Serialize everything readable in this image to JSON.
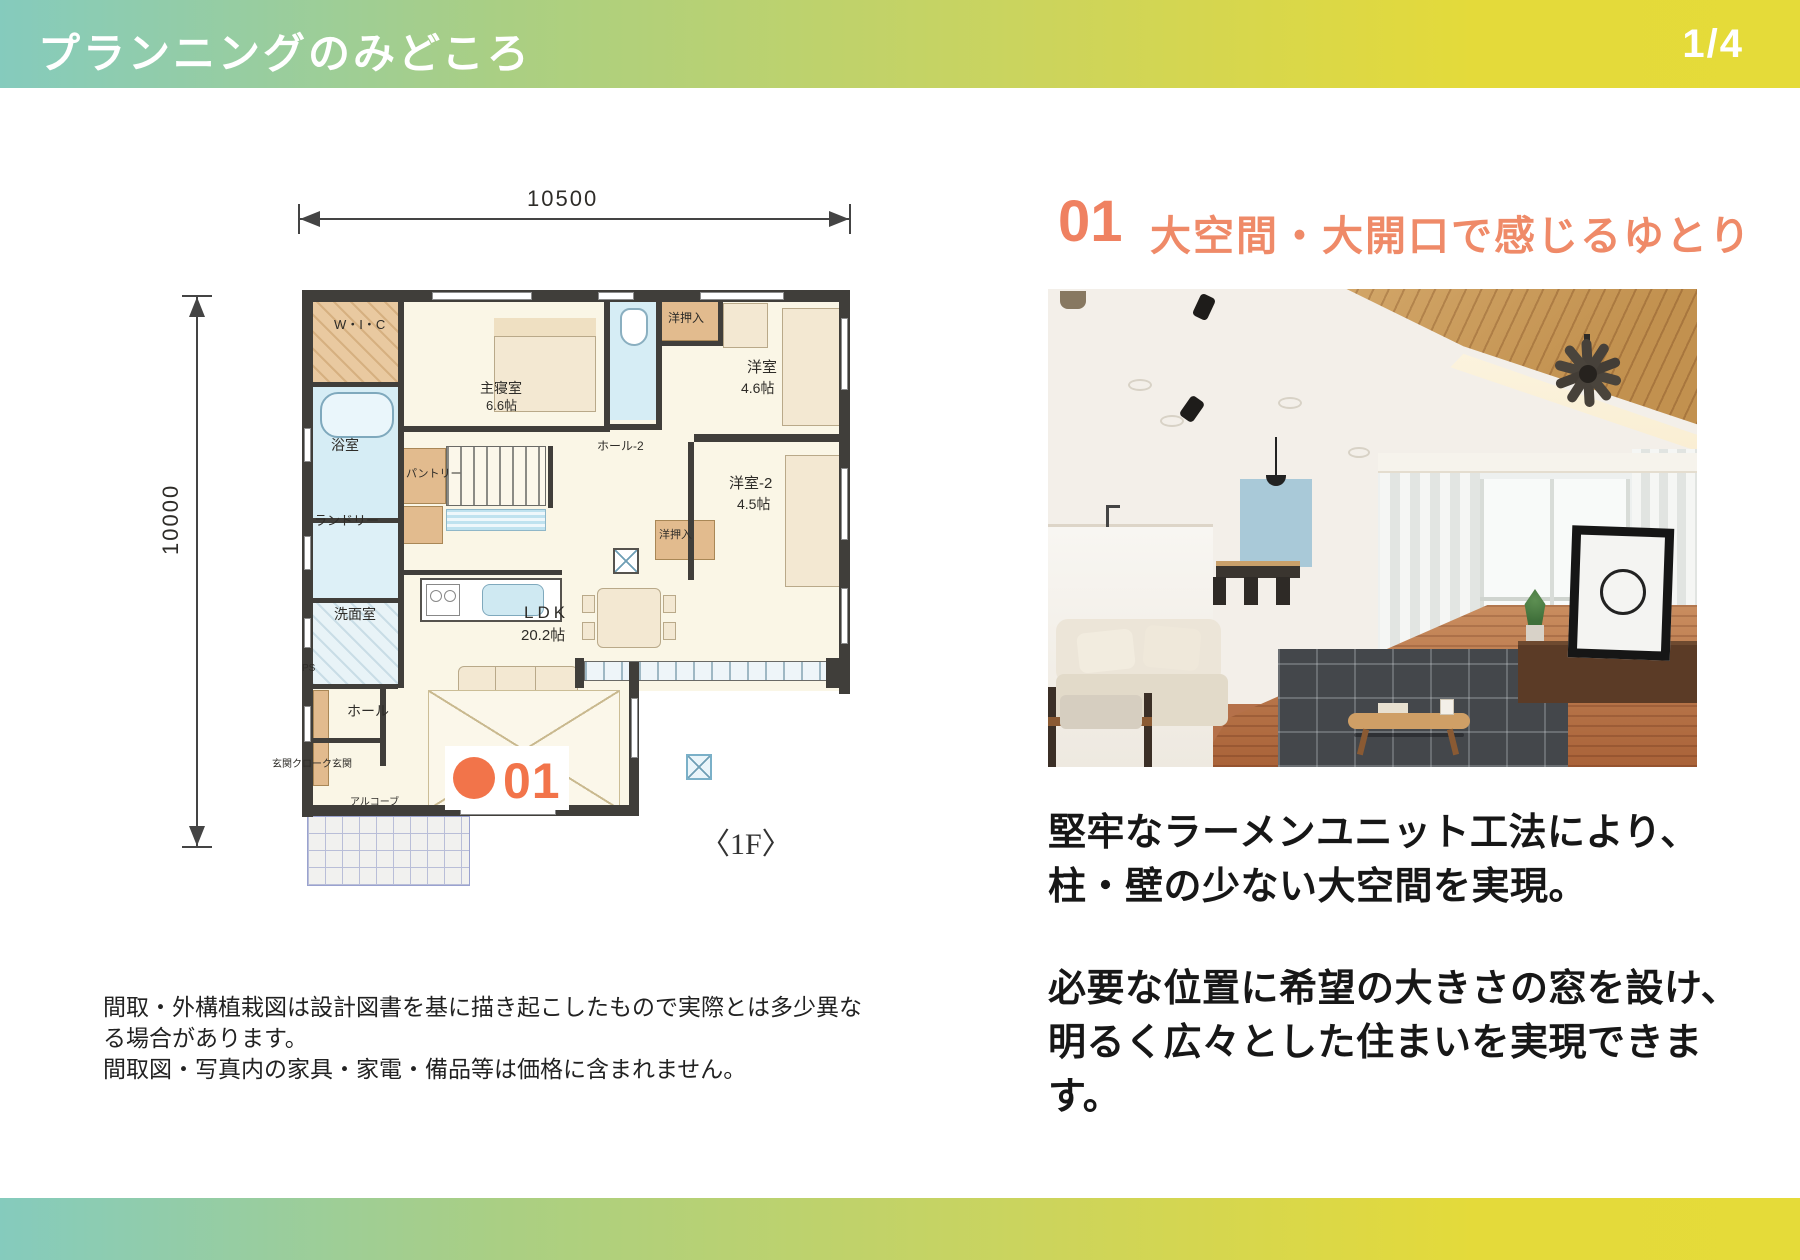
{
  "header": {
    "title": "プランニングのみどころ",
    "page": "1/4"
  },
  "section": {
    "number": "01",
    "title": "大空間・大開口で感じるゆとり"
  },
  "body": {
    "para1_line1": "堅牢なラーメンユニット工法により、",
    "para1_line2": "柱・壁の少ない大空間を実現。",
    "para2": "必要な位置に希望の大きさの窓を設け、明るく広々とした住まいを実現できます。"
  },
  "disclaimer": {
    "line1": "間取・外構植栽図は設計図書を基に描き起こしたもので実際とは多少異なる場合があります。",
    "line2": "間取図・写真内の家具・家電・備品等は価格に含まれません。"
  },
  "floorplan": {
    "dim_width": "10500",
    "dim_height": "10000",
    "floor_label": "〈1F〉",
    "marker_number": "01",
    "labels": [
      {
        "text": "W・I・C",
        "x": 334,
        "y": 318,
        "size": 13
      },
      {
        "text": "浴室",
        "x": 331,
        "y": 438,
        "size": 14
      },
      {
        "text": "ランドリー",
        "x": 314,
        "y": 514,
        "size": 13
      },
      {
        "text": "洗面室",
        "x": 334,
        "y": 607,
        "size": 14
      },
      {
        "text": "PS",
        "x": 302,
        "y": 664,
        "size": 10
      },
      {
        "text": "ホール",
        "x": 347,
        "y": 704,
        "size": 14
      },
      {
        "text": "玄関クローク玄関",
        "x": 272,
        "y": 760,
        "size": 10
      },
      {
        "text": "アルコーブ",
        "x": 350,
        "y": 798,
        "size": 10
      },
      {
        "text": "主寝室",
        "x": 480,
        "y": 381,
        "size": 14
      },
      {
        "text": "6.6帖",
        "x": 486,
        "y": 399,
        "size": 13
      },
      {
        "text": "パントリー",
        "x": 406,
        "y": 469,
        "size": 11
      },
      {
        "text": "ホール-2",
        "x": 597,
        "y": 440,
        "size": 12
      },
      {
        "text": "洋押入",
        "x": 668,
        "y": 312,
        "size": 12
      },
      {
        "text": "洋室",
        "x": 747,
        "y": 360,
        "size": 15
      },
      {
        "text": "4.6帖",
        "x": 741,
        "y": 381,
        "size": 14
      },
      {
        "text": "洋室-2",
        "x": 729,
        "y": 476,
        "size": 15
      },
      {
        "text": "4.5帖",
        "x": 737,
        "y": 497,
        "size": 14
      },
      {
        "text": "洋押入",
        "x": 659,
        "y": 530,
        "size": 11
      },
      {
        "text": "LDK",
        "x": 524,
        "y": 604,
        "size": 17,
        "ls": 4
      },
      {
        "text": "20.2帖",
        "x": 521,
        "y": 628,
        "size": 15
      }
    ]
  },
  "colors": {
    "accent_orange": "#ef8a68",
    "badge_orange": "#f2744a",
    "gradient_left": "#85cbbd",
    "gradient_right": "#e5db39"
  }
}
